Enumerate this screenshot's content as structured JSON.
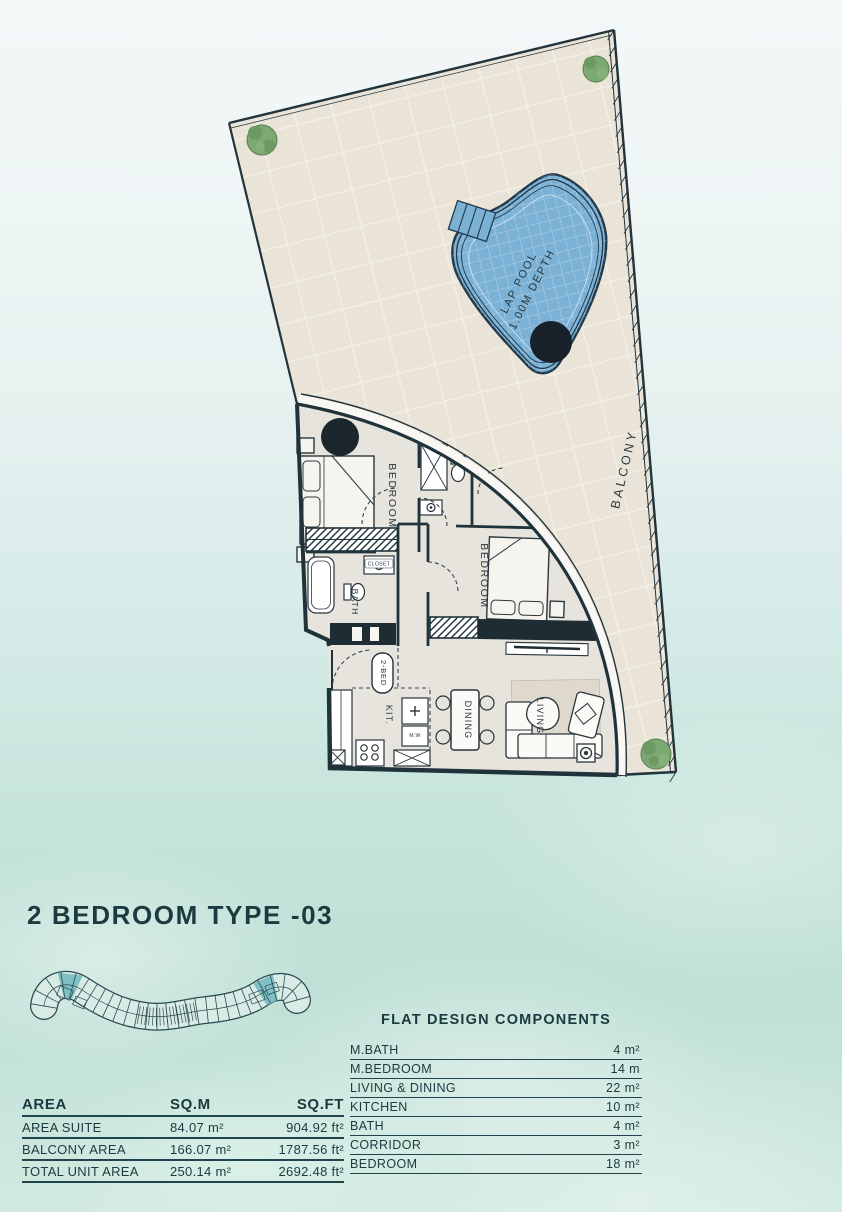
{
  "title": "2 BEDROOM TYPE -03",
  "plan": {
    "balcony": "BALCONY",
    "pool_line1": "LAP POOL",
    "pool_line2": "1.00M DEPTH",
    "master_bedroom": "BEDROOM",
    "bedroom2": "BEDROOM",
    "bath": "BATH",
    "kitchen": "KIT.",
    "dining": "DINING",
    "living": "LIVING",
    "unit_tag": "2-BED",
    "microwave": "M.W",
    "closet": "CLOSET"
  },
  "area_table": {
    "headers": [
      "AREA",
      "SQ.M",
      "SQ.FT"
    ],
    "rows": [
      {
        "label": "AREA SUITE",
        "sqm": "84.07 m²",
        "sqft": "904.92 ft²"
      },
      {
        "label": "BALCONY AREA",
        "sqm": "166.07 m²",
        "sqft": "1787.56 ft²"
      },
      {
        "label": "TOTAL UNIT AREA",
        "sqm": "250.14 m²",
        "sqft": "2692.48 ft²"
      }
    ]
  },
  "components_table": {
    "title": "FLAT DESIGN COMPONENTS",
    "rows": [
      {
        "label": "M.BATH",
        "value": "4 m²"
      },
      {
        "label": "M.BEDROOM",
        "value": "14 m"
      },
      {
        "label": "LIVING & DINING",
        "value": "22 m²"
      },
      {
        "label": "KITCHEN",
        "value": "10 m²"
      },
      {
        "label": "BATH",
        "value": "4 m²"
      },
      {
        "label": "CORRIDOR",
        "value": "3 m²"
      },
      {
        "label": "BEDROOM",
        "value": "18 m²"
      }
    ]
  },
  "colors": {
    "pool_blue": "#7bb1d5",
    "terrace_beige": "#eae4d8",
    "ink": "#22343c",
    "keyplan_highlight": "#6fb8bd",
    "water_teal": "#c5e3da"
  }
}
